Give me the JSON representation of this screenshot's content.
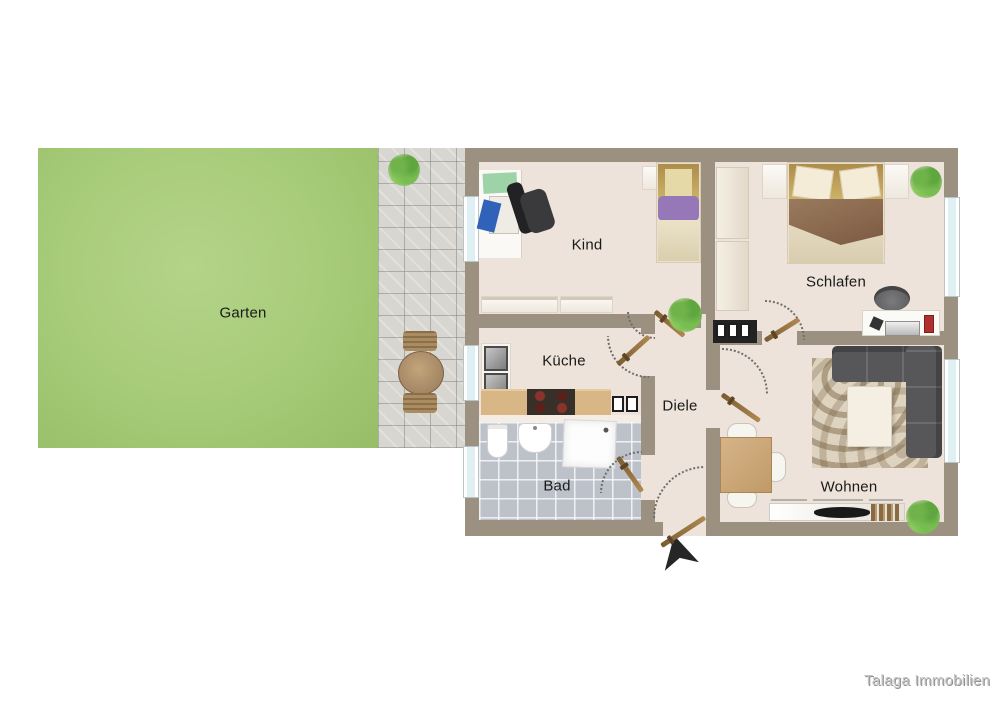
{
  "plan": {
    "watermark": "Talaga Immobilien",
    "outdoor": {
      "garten": {
        "label": "Garten",
        "features": [
          "lawn"
        ]
      },
      "terrasse": {
        "features": [
          "paving",
          "plant-icon",
          "garden-table-icon",
          "garden-chair-icon"
        ]
      }
    },
    "rooms": {
      "kind": {
        "label": "Kind",
        "furniture": [
          "desk-icon",
          "office-chair-icon",
          "single-bed-icon",
          "nightstand-icon",
          "sideboard-icon",
          "window-icon",
          "door-icon",
          "plant-icon"
        ]
      },
      "schlafen": {
        "label": "Schlafen",
        "furniture": [
          "double-bed-icon",
          "nightstand-icon",
          "wardrobe-icon",
          "dresser-icon",
          "desk-icon",
          "chair-icon",
          "plant-icon",
          "window-icon",
          "door-icon"
        ]
      },
      "kueche": {
        "label": "Küche",
        "furniture": [
          "sink-icon",
          "stove-icon",
          "counter-icon",
          "cabinet-icon",
          "window-icon",
          "door-icon"
        ]
      },
      "diele": {
        "label": "Diele",
        "furniture": [
          "entrance-door-icon",
          "entrance-arrow-icon"
        ]
      },
      "bad": {
        "label": "Bad",
        "furniture": [
          "toilet-icon",
          "washbasin-icon",
          "shower-icon",
          "window-icon",
          "door-icon"
        ]
      },
      "wohnen": {
        "label": "Wohnen",
        "furniture": [
          "corner-sofa-icon",
          "rug-icon",
          "coffee-table-icon",
          "dining-table-icon",
          "chair-icon",
          "tv-lowboard-icon",
          "tv-icon",
          "books-icon",
          "plant-icon",
          "window-icon",
          "door-icon"
        ]
      }
    },
    "colors": {
      "garden": "#a6cb78",
      "terrace": "#d7d6d1",
      "wall": "#9c9080",
      "floor": "#ede3da",
      "bath_tile": "#bdc2ca",
      "wood": "#c3a95e",
      "counter": "#d8b685",
      "sofa": "#57575a",
      "window_glass": "#dff0f4",
      "door_leaf": "#b08850",
      "label_text": "#1a1a1a",
      "watermark_text": "#c4c4c4"
    }
  }
}
